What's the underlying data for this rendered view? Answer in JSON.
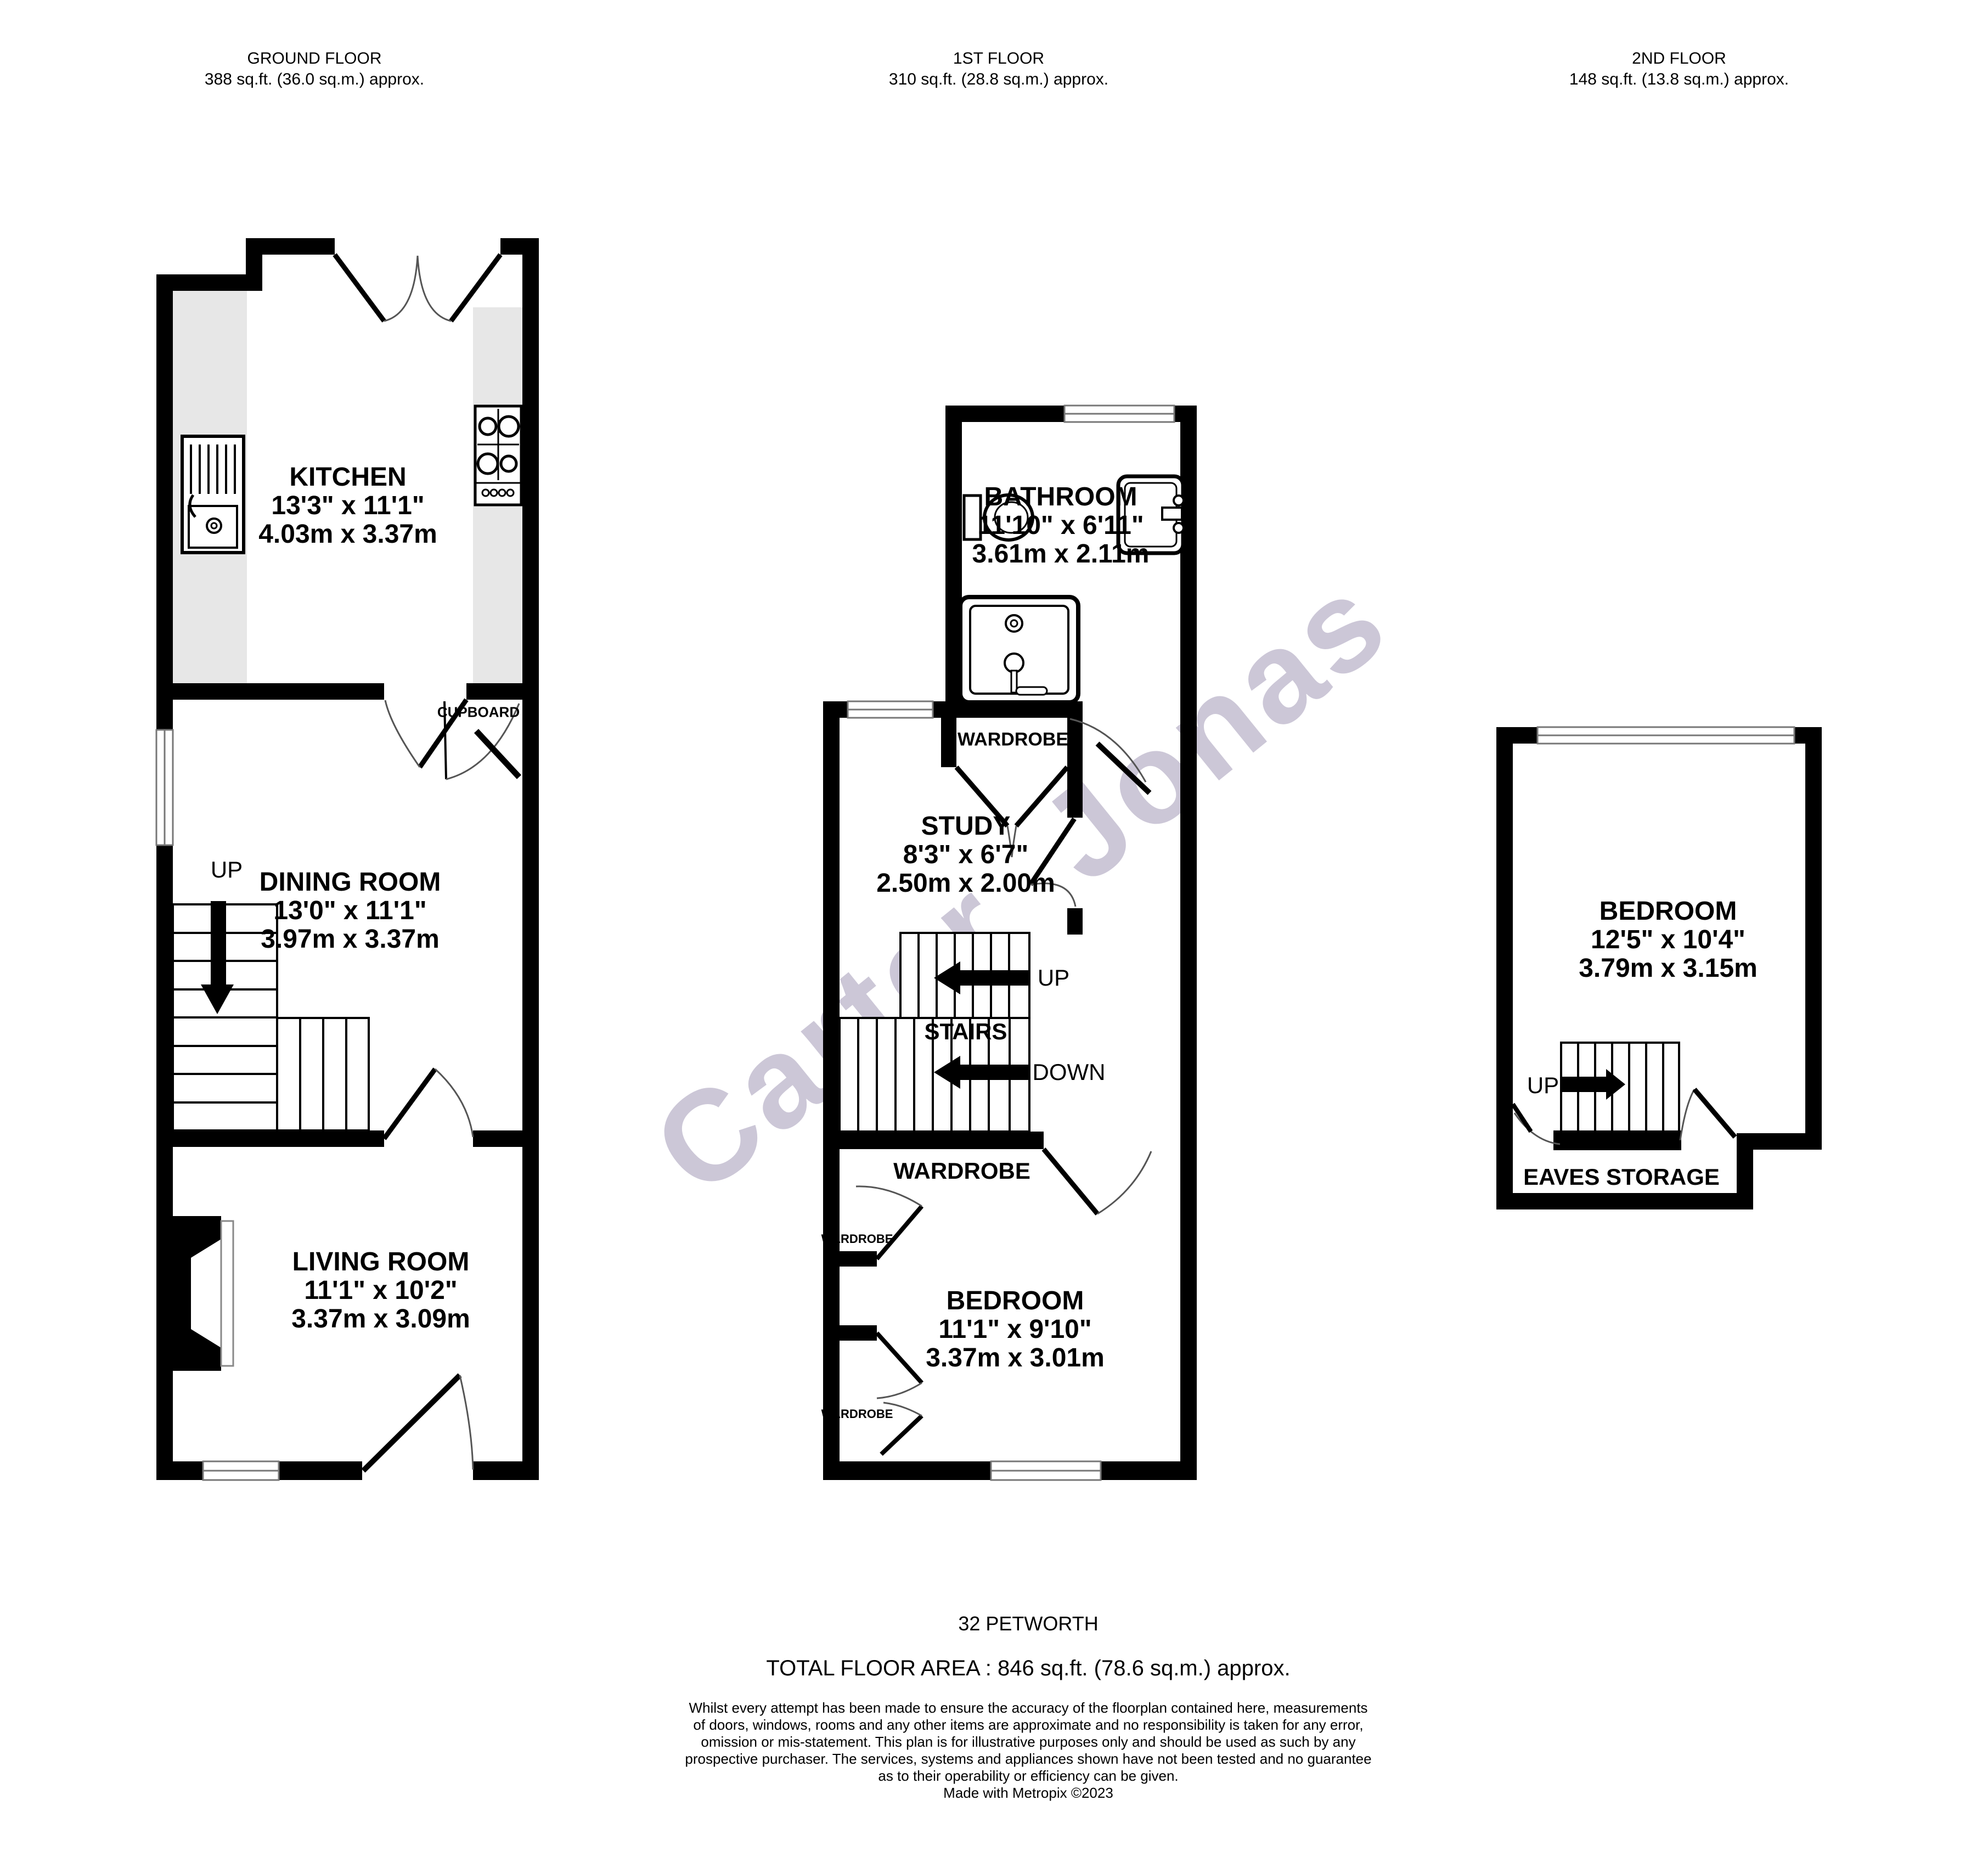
{
  "floors": [
    {
      "title": "GROUND FLOOR",
      "area": "388 sq.ft. (36.0 sq.m.) approx."
    },
    {
      "title": "1ST FLOOR",
      "area": "310 sq.ft. (28.8 sq.m.) approx."
    },
    {
      "title": "2ND FLOOR",
      "area": "148 sq.ft. (13.8 sq.m.) approx."
    }
  ],
  "rooms": {
    "kitchen": {
      "name": "KITCHEN",
      "imperial": "13'3\"  x 11'1\"",
      "metric": "4.03m  x 3.37m"
    },
    "dining": {
      "name": "DINING ROOM",
      "imperial": "13'0\"  x 11'1\"",
      "metric": "3.97m  x 3.37m"
    },
    "living": {
      "name": "LIVING ROOM",
      "imperial": "11'1\"  x 10'2\"",
      "metric": "3.37m  x 3.09m"
    },
    "bathroom": {
      "name": "BATHROOM",
      "imperial": "11'10\"  x 6'11\"",
      "metric": "3.61m  x 2.11m"
    },
    "study": {
      "name": "STUDY",
      "imperial": "8'3\"  x 6'7\"",
      "metric": "2.50m  x 2.00m"
    },
    "bedroom1": {
      "name": "BEDROOM",
      "imperial": "11'1\"  x 9'10\"",
      "metric": "3.37m  x 3.01m"
    },
    "bedroom2": {
      "name": "BEDROOM",
      "imperial": "12'5\"  x 10'4\"",
      "metric": "3.79m  x 3.15m"
    }
  },
  "labels": {
    "cupboard": "CUPBOARD",
    "wardrobe": "WARDROBE",
    "stairs": "STAIRS",
    "up": "UP",
    "down": "DOWN",
    "eaves": "EAVES STORAGE"
  },
  "watermark": {
    "text": "Carter Jonas",
    "color": "#b9b2c8"
  },
  "footer": {
    "address": "32 PETWORTH",
    "total_area": "TOTAL FLOOR AREA : 846 sq.ft. (78.6 sq.m.) approx.",
    "disclaimer_lines": [
      "Whilst every attempt has been made to ensure the accuracy of the floorplan contained here, measurements",
      "of doors, windows, rooms and any other items are approximate and no responsibility is taken for any error,",
      "omission or mis-statement. This plan is for illustrative purposes only and should be used as such by any",
      "prospective purchaser. The services, systems and appliances shown have not been tested and no guarantee",
      "as to their operability or efficiency can be given."
    ],
    "credit": "Made with Metropix ©2023"
  }
}
